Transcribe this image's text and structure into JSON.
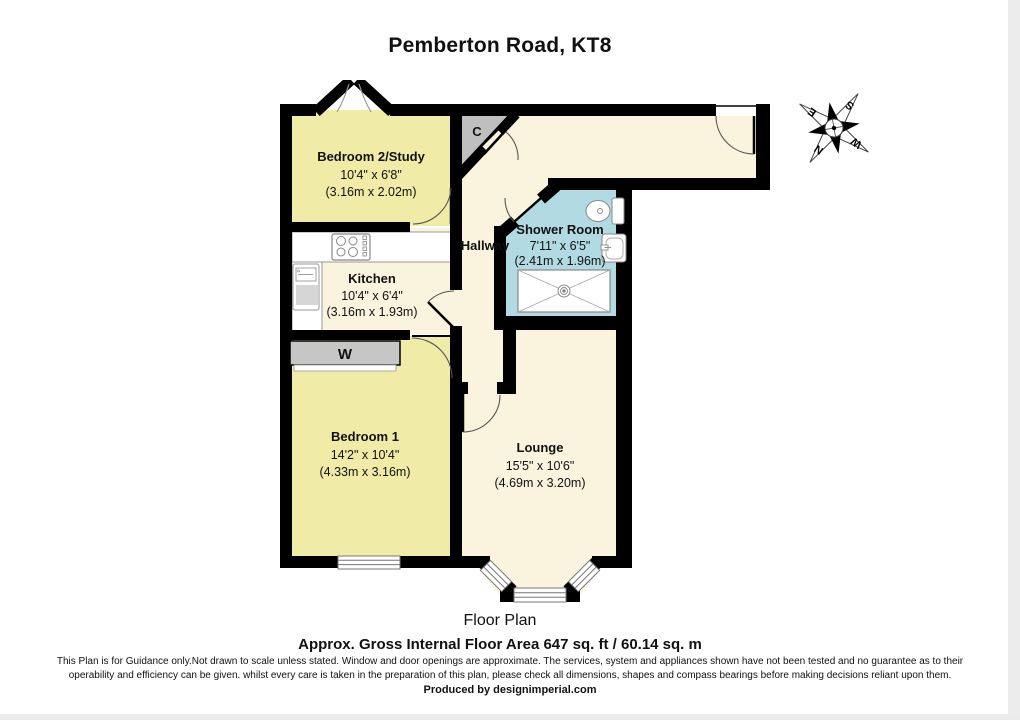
{
  "title": "Pemberton Road, KT8",
  "rooms": {
    "bedroom2": {
      "name": "Bedroom 2/Study",
      "size_ft": "10'4\" x 6'8\"",
      "size_m": "(3.16m x 2.02m)"
    },
    "kitchen": {
      "name": "Kitchen",
      "size_ft": "10'4\" x 6'4\"",
      "size_m": "(3.16m x 1.93m)"
    },
    "shower_room": {
      "name": "Shower Room",
      "size_ft": "7'11\" x 6'5\"",
      "size_m": "(2.41m x 1.96m)"
    },
    "bedroom1": {
      "name": "Bedroom 1",
      "size_ft": "14'2\" x 10'4\"",
      "size_m": "(4.33m x 3.16m)"
    },
    "lounge": {
      "name": "Lounge",
      "size_ft": "15'5\" x 10'6\"",
      "size_m": "(4.69m x 3.20m)"
    },
    "hallway": {
      "name": "Hallway"
    },
    "cupboard": {
      "label": "C"
    },
    "wardrobe": {
      "label": "W"
    }
  },
  "compass": {
    "north": "N",
    "east": "E",
    "south": "S",
    "west": "W"
  },
  "footer": {
    "plan_label": "Floor Plan",
    "area_line": "Approx. Gross Internal Floor Area 647 sq. ft /  60.14 sq. m",
    "disclaimer_line1": "This Plan is for Guidance only.Not drawn to scale unless stated. Window and door openings are approximate. The services, system and appliances shown have not been tested and no guarantee as to their",
    "disclaimer_line2": "operability and efficiency can be given. whilst every care is taken in the preparation of this plan, please check all dimensions, shapes and compass bearings before making decisions reliant upon them.",
    "produced_by": "Produced by designimperial.com"
  },
  "colors": {
    "room_yellow": "#f0eca8",
    "floor_cream": "#faf3dd",
    "shower_blue": "#b2dae2",
    "closet_gray": "#bfbfbf",
    "wall_black": "#000000"
  }
}
